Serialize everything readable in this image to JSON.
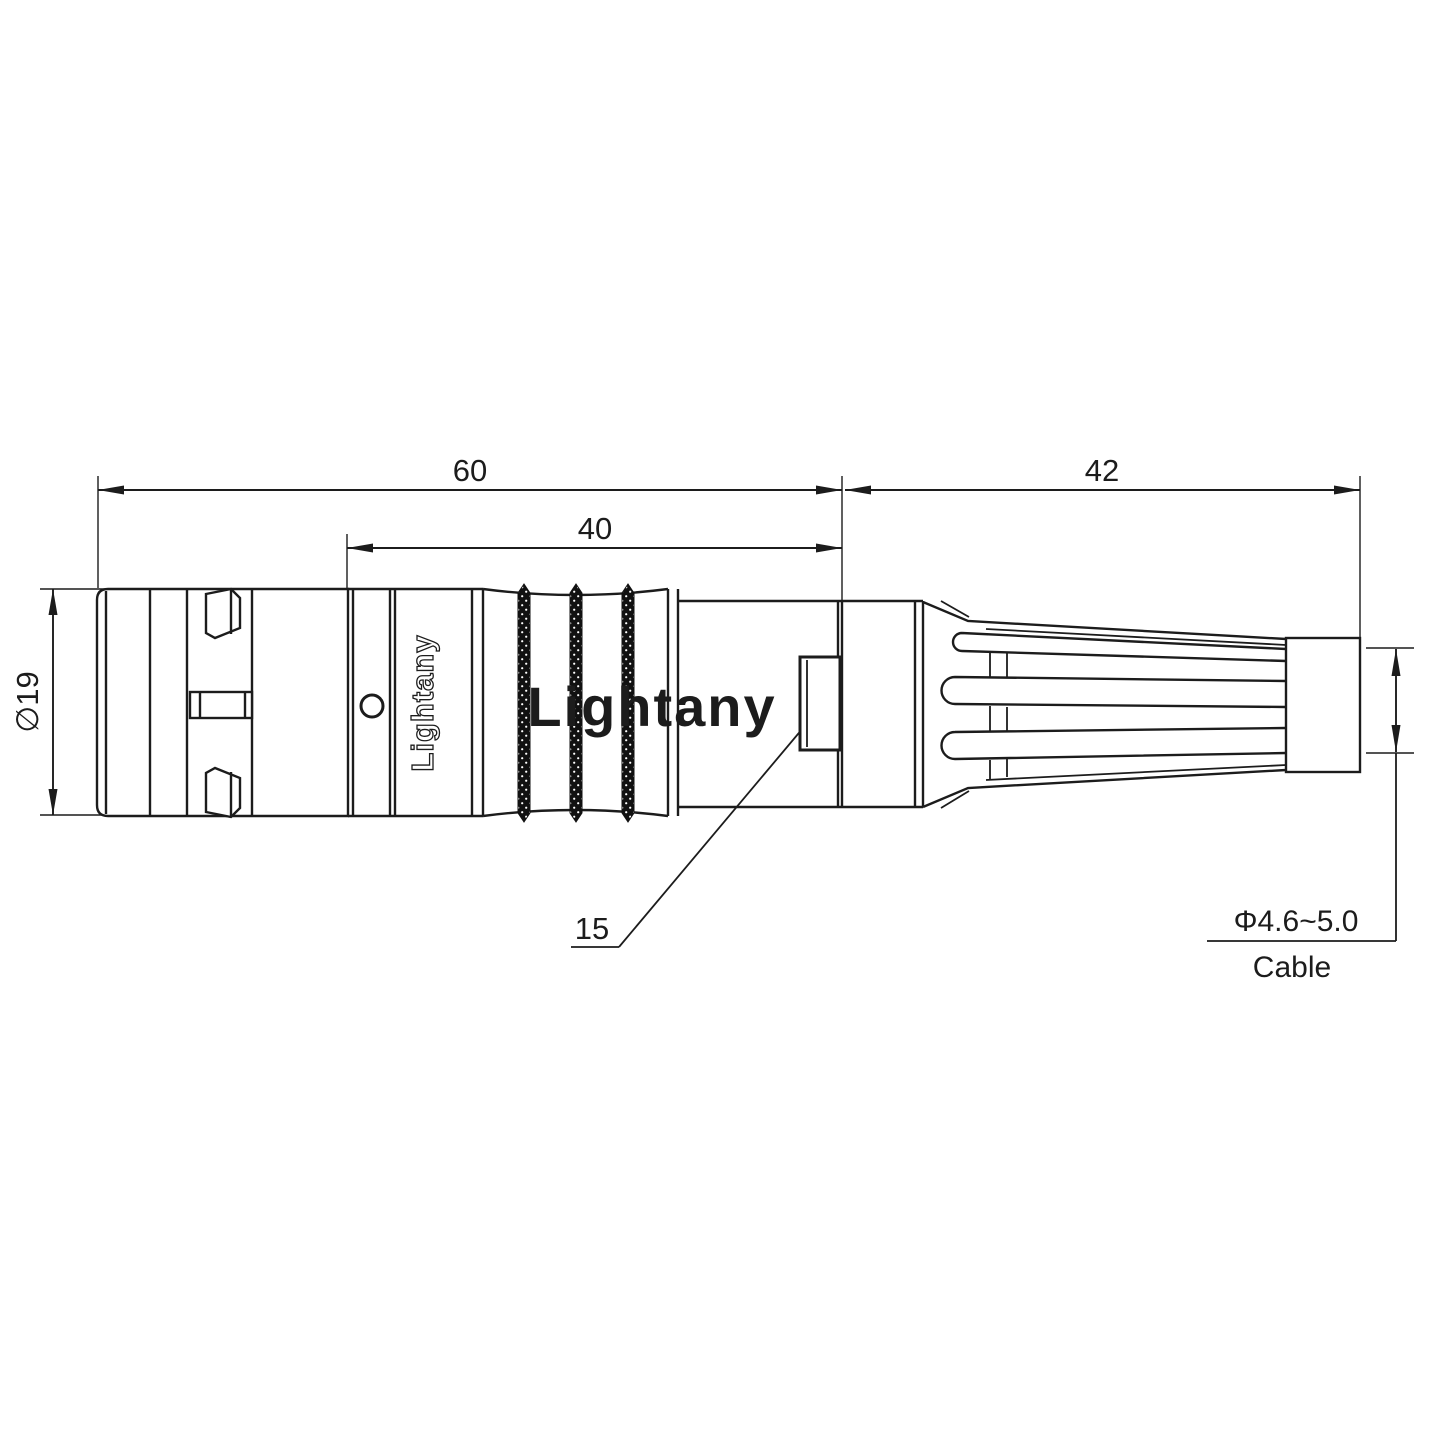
{
  "watermark": "Lightany",
  "connector": {
    "logo": "Lightany"
  },
  "dimensions": {
    "overall_length": "60",
    "front_length": "40",
    "boot_length": "42",
    "shell_diameter": "∅19",
    "latch_ref": "15",
    "cable_diameter": "Φ4.6~5.0",
    "cable_label": "Cable"
  },
  "colors": {
    "line": "#1c1c1c",
    "watermark": "#e57373",
    "background": "#ffffff"
  }
}
